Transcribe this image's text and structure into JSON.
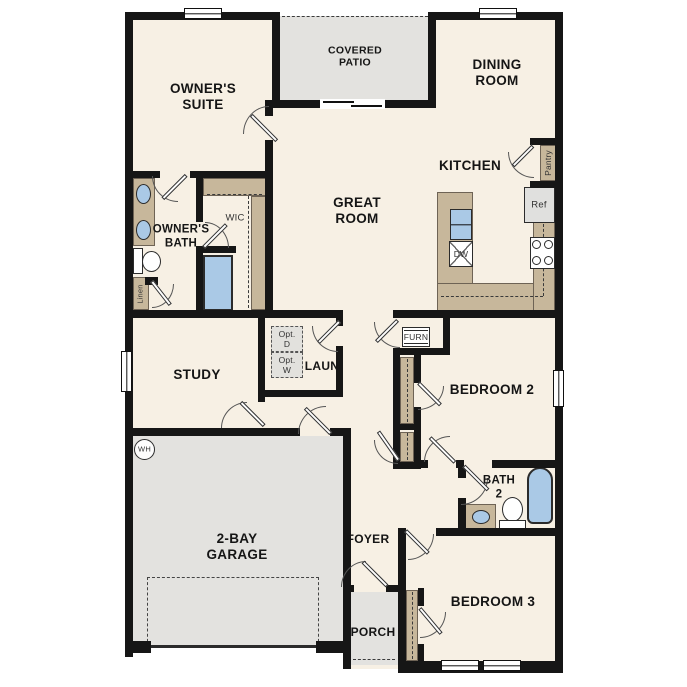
{
  "rooms": {
    "owners_suite": "OWNER'S\nSUITE",
    "covered_patio": "COVERED\nPATIO",
    "dining_room": "DINING\nROOM",
    "great_room": "GREAT\nROOM",
    "kitchen": "KITCHEN",
    "owners_bath": "OWNER'S\nBATH",
    "wic": "WIC",
    "study": "STUDY",
    "laundry": "LAUN",
    "bedroom_2": "BEDROOM 2",
    "bath_2": "BATH\n2",
    "bedroom_3": "BEDROOM 3",
    "garage": "2-BAY\nGARAGE",
    "foyer": "FOYER",
    "porch": "PORCH"
  },
  "fixtures": {
    "pantry": "Pantry",
    "refrigerator": "Ref",
    "dishwasher": "DW",
    "furnace": "FURN",
    "linen": "Linen",
    "water_heater": "WH",
    "optional_dryer": "Opt.\nD",
    "optional_washer": "Opt.\nW"
  },
  "colors": {
    "wall": "#161616",
    "floor": "#f7f0e4",
    "hardscape": "#e3e2df",
    "casework": "#c7b79b",
    "plumbing_fixture": "#aac9e6"
  }
}
